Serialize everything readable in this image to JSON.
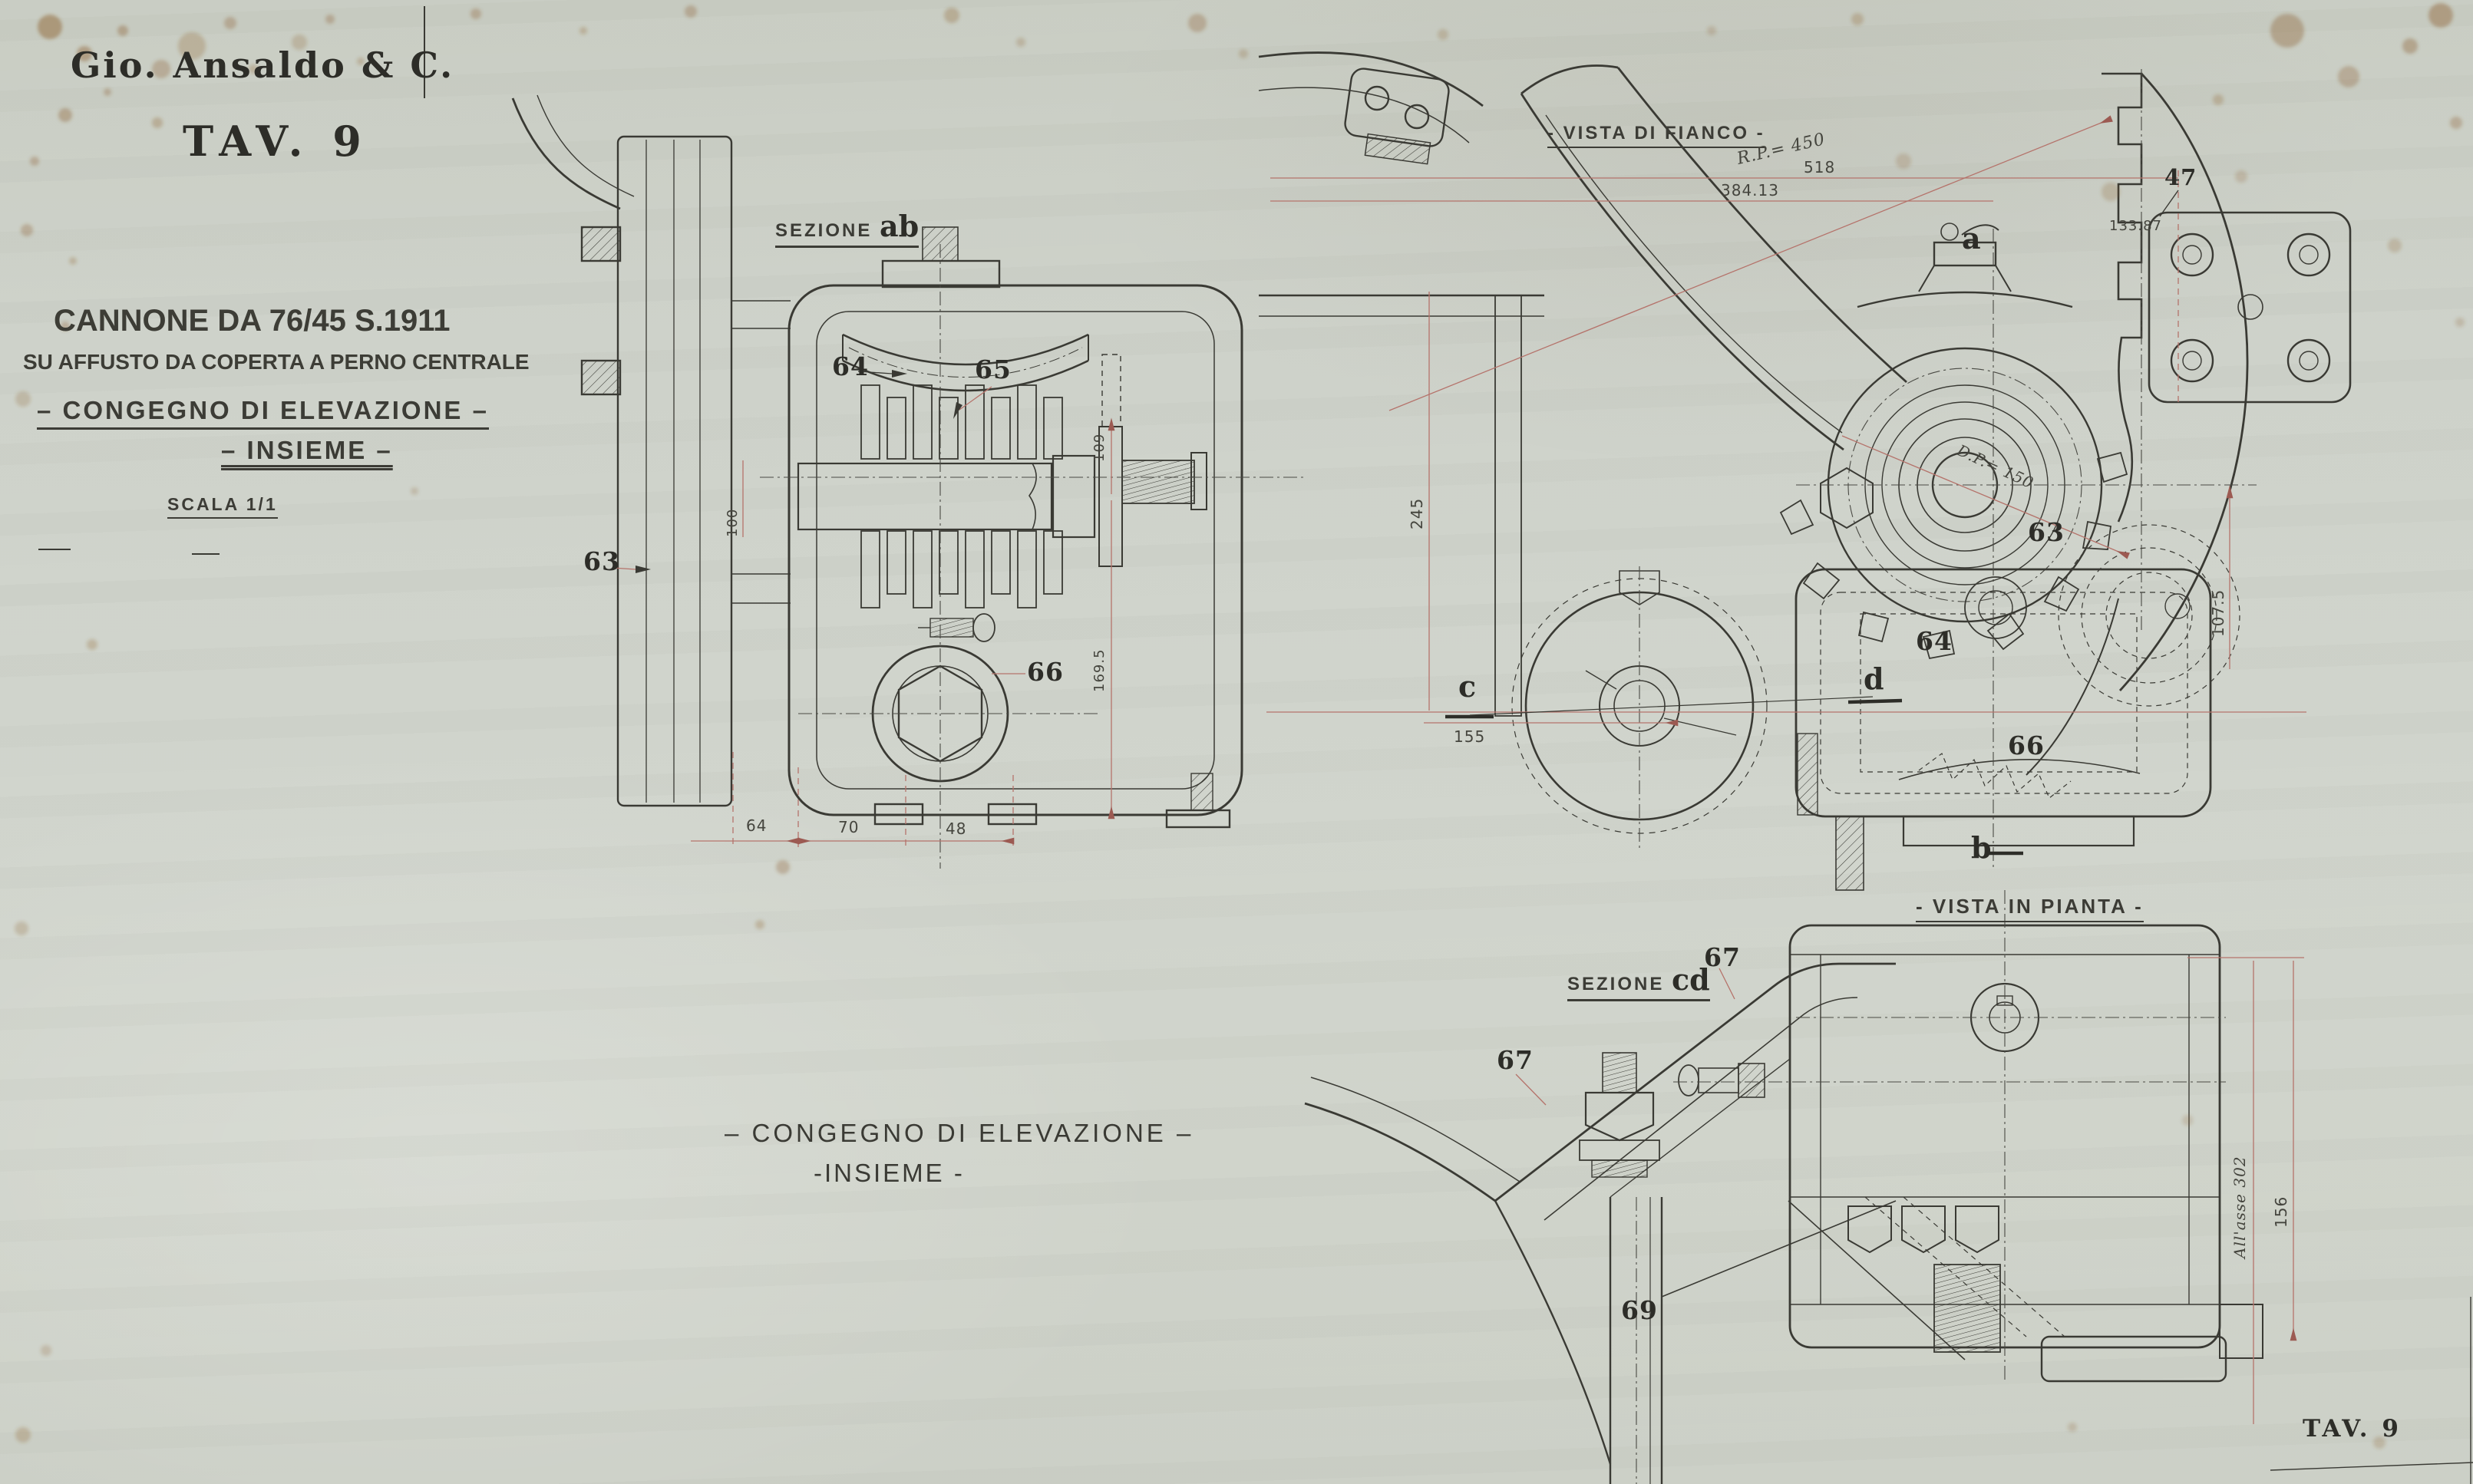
{
  "colors": {
    "paper": "#cdd1c9",
    "ink": "#3a3a34",
    "dimline_red": "#b5736b",
    "stain": "#8a5a28"
  },
  "title_block": {
    "company": "Gio. Ansaldo & C.",
    "plate": "TAV. 9"
  },
  "subject": {
    "line1": "CANNONE DA 76/45 S.1911",
    "line2": "SU AFFUSTO DA COPERTA A PERNO CENTRALE",
    "line3": "– CONGEGNO DI ELEVAZIONE –",
    "line4": "– INSIEME –",
    "scale": "SCALA  1/1"
  },
  "views": {
    "sezione_ab": {
      "prefix": "SEZIONE ",
      "letters": "ab"
    },
    "vista_fianco": "- VISTA DI FIANCO -",
    "vista_pianta": "- VISTA IN PIANTA -",
    "sezione_cd": {
      "prefix": "SEZIONE ",
      "letters": "cd"
    }
  },
  "caption": {
    "line1": "– CONGEGNO DI ELEVAZIONE –",
    "line2": "-INSIEME -"
  },
  "letters": {
    "a": "a",
    "b": "b",
    "c": "c",
    "d": "d"
  },
  "parts": {
    "p47": "47",
    "p63L": "63",
    "p64L": "64",
    "p65": "65",
    "p66L": "66",
    "p63R": "63",
    "p64R": "64",
    "p66R": "66",
    "p67a": "67",
    "p67b": "67",
    "p69": "69"
  },
  "dims": {
    "rp450": "R.P.= 450",
    "d518": "518",
    "d384": "384.13",
    "d133": "133.87",
    "dp150": "D.P.=  150",
    "d245": "245",
    "d107": "107.5",
    "d155": "155",
    "d100": "100",
    "d109": "109",
    "d169": "169.5",
    "d64": "64",
    "d70": "70",
    "d48": "48",
    "asse": "All'asse  302",
    "d156": "156"
  },
  "footer": {
    "plate": "TAV. 9"
  }
}
